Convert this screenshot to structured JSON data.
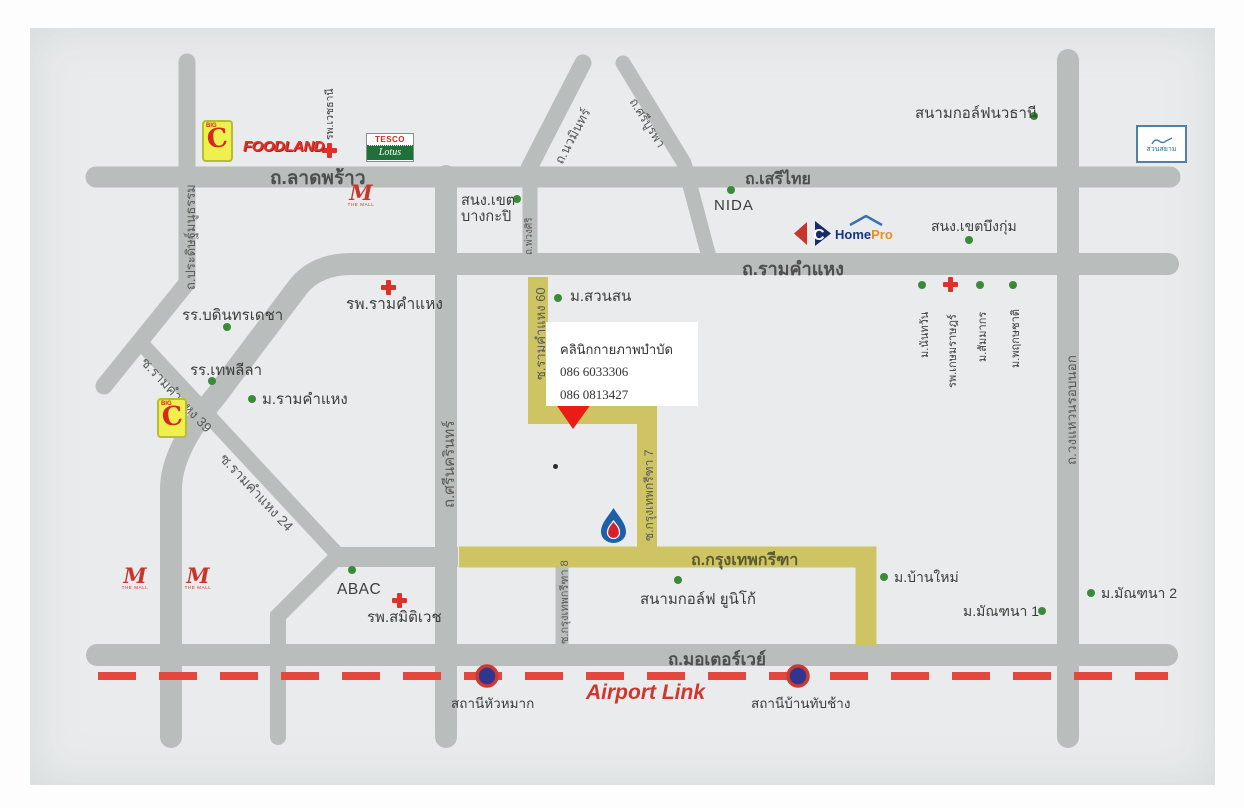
{
  "roads": {
    "ladprao": "ถ.ลาดพร้าว",
    "serithai": "ถ.เสรีไทย",
    "ramkhamhaeng": "ถ.รามคำแหง",
    "motorway": "ถ.มอเตอร์เวย์",
    "krungthep_kreetha": "ถ.กรุงเทพกรีฑา",
    "pradit_manutham": "ถ.ประดิษฐ์มนูธรรม",
    "srinakarin": "ถ.ศรีนครินทร์",
    "nawamin": "ถ.นวมินทร์",
    "sri_burapha": "ถ.ศรีบูรพา",
    "phuang_siri": "ถ.พ่วงศิริ",
    "outer_ring": "ถ.วงแหวนรอบนอก",
    "soi_ramkhamhaeng_60": "ซ.รามคำแหง 60",
    "soi_ramkhamhaeng_39": "ซ.รามคำแหง 39",
    "soi_ramkhamhaeng_24": "ซ.รามคำแหง 24",
    "soi_krungthep_kreetha_7": "ซ.กรุงเทพกรีฑา 7",
    "soi_krungthep_kreetha_8": "ซ.กรุงเทพกรีฑา 8"
  },
  "clinic": {
    "name": "คลินิกกายภาพบำบัด",
    "phone1": "086 6033306",
    "phone2": "086 0813427"
  },
  "transit": {
    "airport_link": "Airport Link",
    "station_hua_mak": "สถานีหัวหมาก",
    "station_ban_thap_chang": "สถานีบ้านทับช้าง"
  },
  "pois": {
    "bangkapi_office_1": "สนง.เขต",
    "bangkapi_office_2": "บางกะปิ",
    "nida": "NIDA",
    "navatanee_golf": "สนามกอล์ฟนวธานี",
    "buengkum_office": "สนง.เขตบึงกุ่ม",
    "nantawan": "ม.นันทวัน",
    "kasemrad_hospital": "รพ.เกษมราษฎร์",
    "sammakorn": "ม.สัมมากร",
    "phruksachat": "ม.พฤกษชาติ",
    "suan_son": "ม.สวนสน",
    "ramkhamhaeng_hospital": "รพ.รามคำแหง",
    "vejthani_hospital": "รพ.เวชธานี",
    "bodindecha_school": "รร.บดินทรเดชา",
    "thepleela_school": "รร.เทพลีลา",
    "ramkhamhaeng_university": "ม.รามคำแหง",
    "abac": "ABAC",
    "samitivej_hospital": "รพ.สมิติเวช",
    "unico_golf": "สนามกอล์ฟ ยูนิโก้",
    "ban_mai": "ม.บ้านใหม่",
    "manthana_1": "ม.มัณฑนา 1",
    "manthana_2": "ม.มัณฑนา 2"
  },
  "logos": {
    "big_c_top": "BIG",
    "big_c_letter": "C",
    "foodland": "FOODLAND",
    "tesco": "TESCO",
    "lotus": "Lotus",
    "the_mall_m": "M",
    "the_mall_caption": "THE MALL",
    "carrefour_letter": "C",
    "homepro_home": "Home",
    "homepro_pro": "Pro",
    "suan_siam": "สวนสยาม"
  },
  "colors": {
    "road_gray": "#b9bdbc",
    "route_yellow": "#cfc463",
    "accent_red": "#e3473d",
    "poi_green": "#3a8a3a",
    "station_blue": "#30368f",
    "map_bg": "#e9ebec"
  }
}
